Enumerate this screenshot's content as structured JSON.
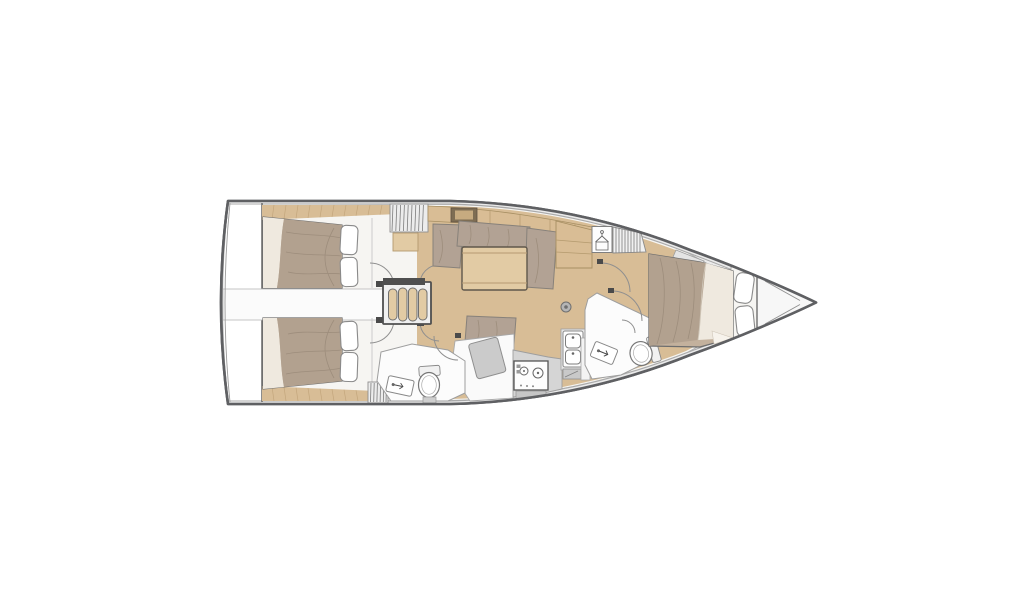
{
  "meta": {
    "type": "sailboat-interior-floor-plan",
    "view": "top-down",
    "bow_direction": "right",
    "canvas": {
      "width": 1024,
      "height": 600
    },
    "background": "#ffffff"
  },
  "palette": {
    "hull_outline": "#5f6063",
    "inner_hull_line": "#a8a8a8",
    "deck": "#ebebeb",
    "interior": "#f6f5f2",
    "wood_floor": "#d8bd96",
    "wood_light": "#e2cba4",
    "cabinet_wood": "#d9bd95",
    "mattress": "#b2a18f",
    "mattress_light": "#c3b19d",
    "sheet_white": "#efe9df",
    "cushion": "#b2a294",
    "fixture_white": "#fdfdfd",
    "counter_gray": "#d5d5d5",
    "counter_light": "#e6e6e6",
    "object_gray": "#cbcbcb",
    "line_gray": "#9e9e9e",
    "dark_detail": "#4f4f4f",
    "hinge_dark": "#4a4a4a",
    "band_white": "#fbfbfb",
    "room_white": "#fcfcfc",
    "opening_dark": "#7e6d53",
    "opening_inner": "#c7ab80"
  },
  "regions": [
    {
      "name": "transom-swim-platform"
    },
    {
      "name": "aft-cabin-port"
    },
    {
      "name": "aft-cabin-starboard"
    },
    {
      "name": "companionway-stairs"
    },
    {
      "name": "aft-head"
    },
    {
      "name": "saloon"
    },
    {
      "name": "nav-chart-area"
    },
    {
      "name": "galley"
    },
    {
      "name": "forward-head"
    },
    {
      "name": "wardrobe"
    },
    {
      "name": "forward-cabin"
    },
    {
      "name": "anchor-locker"
    }
  ],
  "furniture": {
    "double_berths": 3,
    "pillows": 6,
    "settee": "u-shaped",
    "saloon_table": 1,
    "companionway_steps": 4,
    "stove_burners": 2,
    "sink_basins": 2,
    "toilets": 2,
    "washbasins": 2,
    "hanging_lockers": 2,
    "mast_step": 1,
    "chart_table": 1
  }
}
